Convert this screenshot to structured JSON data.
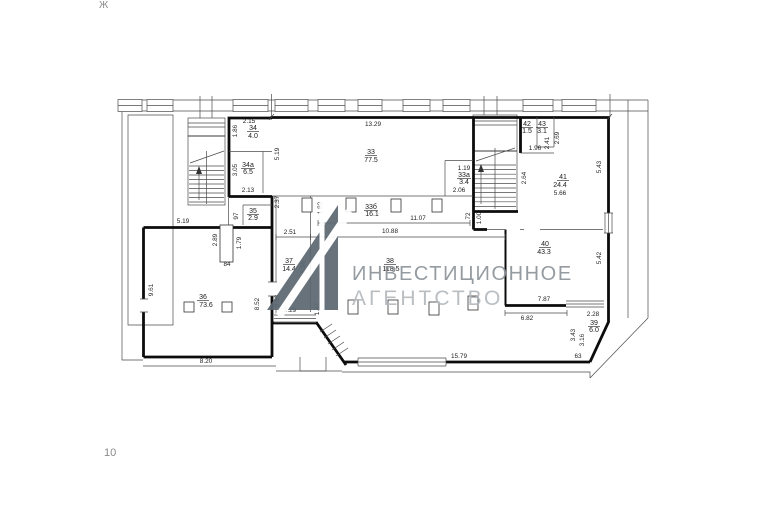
{
  "page": {
    "corner_top": "Ж",
    "corner_bottom": "10"
  },
  "watermark": {
    "line1": "ИНВЕСТИЦИОННОЕ",
    "line2": "АГЕНТСТВО",
    "mark_color": "#5c6770",
    "line1_color": "#8d949a",
    "line2_color": "#b4b9bd"
  },
  "rooms": {
    "r33": {
      "no": "33",
      "area": "77.5"
    },
    "r33a": {
      "no": "33а",
      "area": "3.4"
    },
    "r33b": {
      "no": "33б",
      "area": "16.1"
    },
    "r34": {
      "no": "34",
      "area": "4.0"
    },
    "r34a": {
      "no": "34а",
      "area": "6.5"
    },
    "r35": {
      "no": "35",
      "area": "2.9"
    },
    "r36": {
      "no": "36",
      "area": "73.6"
    },
    "r37": {
      "no": "37",
      "area": "14.4"
    },
    "r38": {
      "no": "38",
      "area": "118.5"
    },
    "r39": {
      "no": "39",
      "area": "6.0"
    },
    "r40": {
      "no": "40",
      "area": "43.3"
    },
    "r41": {
      "no": "41",
      "area": "24.4"
    },
    "r42": {
      "no": "42",
      "area": "1.5"
    },
    "r43": {
      "no": "43",
      "area": "3.1"
    }
  },
  "dims": {
    "d2_15": "2.15",
    "d2_13": "2.13",
    "d13_29": "13.29",
    "d1_19": "1.19",
    "d2_06": "2.06",
    "d1_96": "1.96",
    "d5_66": "5.66",
    "d5_19t": "5.19",
    "d84": "84",
    "d2_51": "2.51",
    "d11_07": "11.07",
    "d10_88": "10.88",
    "d2_29": "2.29",
    "d8_20": "8.20",
    "d15_79": "15.79",
    "d6_82": "6.82",
    "d7_87": "7.87",
    "d2_28": "2.28",
    "d63": "63",
    "d1_86": "1.86",
    "d3_05": "3.05",
    "d97": "97",
    "d5_19l": "5.19",
    "d2_37": "2.37",
    "d2_89": "2.89",
    "d1_79": "1.79",
    "d9_61": "9.61",
    "d2_33": "2.33",
    "d5_96": "5.96",
    "d1_83": "1.83",
    "d1_47": "1.47",
    "d8_52": "8.52",
    "d72": "72",
    "d1_00": "1.00",
    "d2_64": "2.64",
    "d2_69": "2.69",
    "d2_41": "2.41",
    "d5_43": "5.43",
    "d5_42": "5.42",
    "d3_43": "3.43",
    "d3_16": "3.16"
  }
}
